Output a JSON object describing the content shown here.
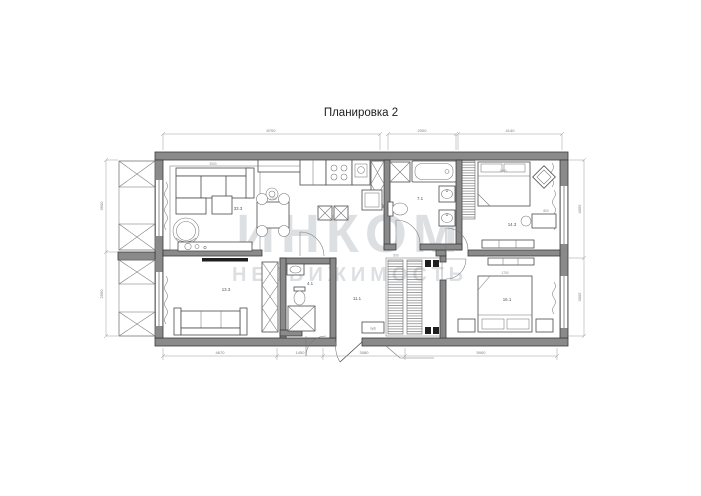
{
  "title": "Планировка 2",
  "watermark": {
    "line1": "ИНКОМ",
    "line2": "НЕДВИЖИМОСТЬ"
  },
  "rooms": {
    "living_kitchen": {
      "area": "33.3"
    },
    "bathroom_main": {
      "area": "7.1"
    },
    "bedroom_top": {
      "area": "14.3"
    },
    "cabinet_room": {
      "area": "13.3"
    },
    "bathroom_small": {
      "area": "4.1"
    },
    "hallway": {
      "area": "11.1"
    },
    "bedroom_bottom": {
      "area": "16.1"
    }
  },
  "furniture": {
    "low_shelf_label": "низкий стеллаж",
    "pouf_label": "пуф"
  },
  "dimensions": {
    "top": [
      "8700",
      "2000",
      "4140"
    ],
    "bottom": [
      "4670",
      "1450",
      "3080",
      "5900"
    ],
    "left": [
      "3900",
      "2950"
    ],
    "right": [
      "4055",
      "3005"
    ],
    "internal": [
      "3000",
      "1200",
      "600",
      "1700",
      "1600",
      "1700",
      "500",
      "800"
    ]
  },
  "colors": {
    "wall_fill": "#8a8a8a",
    "line": "#4a4a4a",
    "dim_line": "#9a9a9a",
    "watermark": "#c9ced3"
  }
}
